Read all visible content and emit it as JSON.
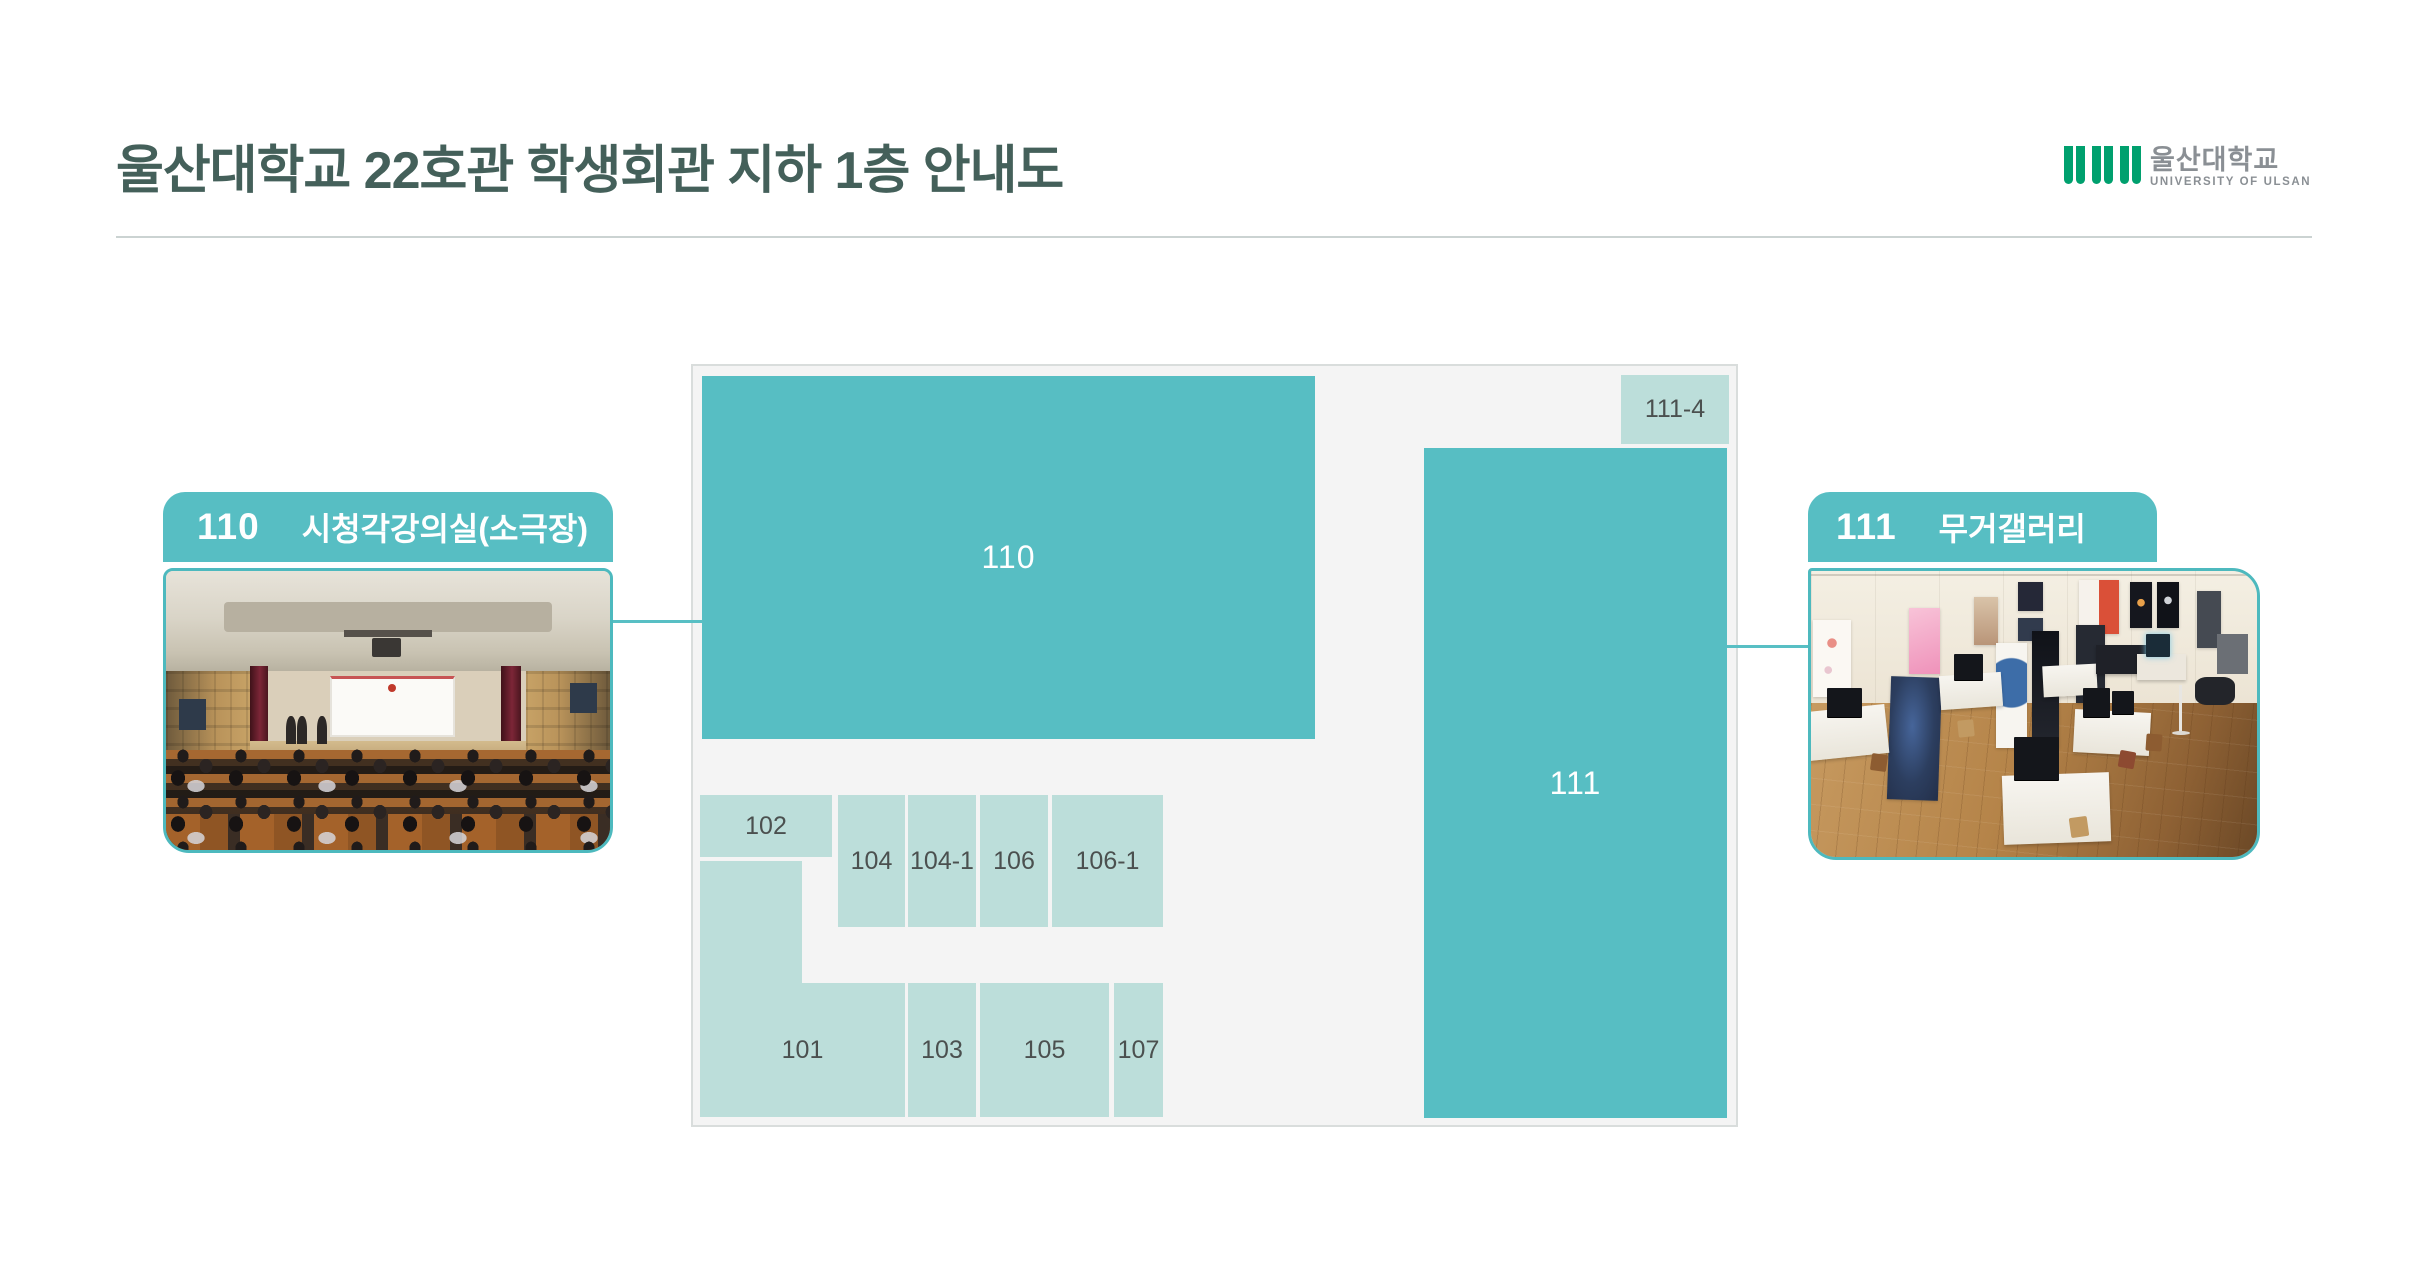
{
  "header": {
    "title": "울산대학교 22호관 학생회관 지하 1층 안내도"
  },
  "logo": {
    "korean": "울산대학교",
    "english": "UNIVERSITY OF ULSAN"
  },
  "floorplan": {
    "rooms": {
      "r110": "110",
      "r111": "111",
      "r111_4": "111-4",
      "r101": "101",
      "r102": "102",
      "r103": "103",
      "r104": "104",
      "r104_1": "104-1",
      "r105": "105",
      "r106": "106",
      "r106_1": "106-1",
      "r107": "107"
    }
  },
  "callouts": {
    "left": {
      "number": "110",
      "name": "시청각강의실(소극장)",
      "photo": "auditorium-photo"
    },
    "right": {
      "number": "111",
      "name": "무거갤러리",
      "photo": "gallery-photo"
    }
  },
  "colors": {
    "accent_teal": "#57bec3",
    "photo_border_teal": "#4db9be",
    "pale_teal": "#bcdeda",
    "title_text": "#44605a",
    "room_label_text": "#4b504f",
    "plan_background": "#f4f4f4",
    "plan_border": "#d9dddc",
    "divider": "#cbd3d2",
    "logo_green": "#00a06e",
    "logo_gray": "#8a8f94"
  }
}
